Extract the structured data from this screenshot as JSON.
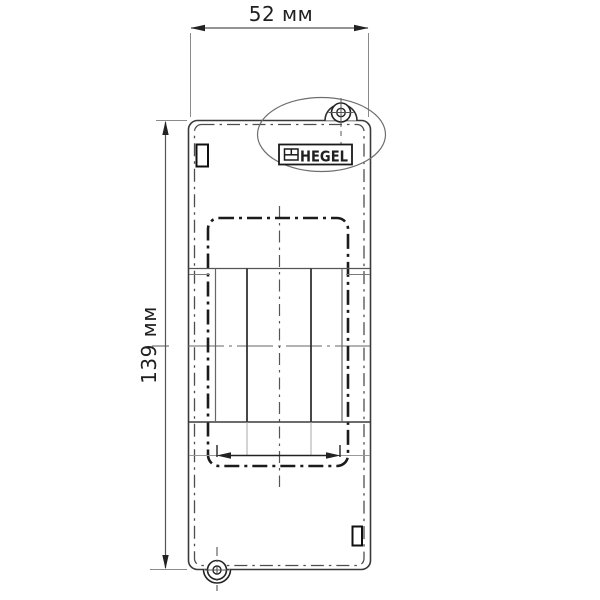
{
  "drawing": {
    "type": "technical-drawing-front-view",
    "brand_label": "HEGEL",
    "dimensions": {
      "width": "52 мм",
      "height": "139 мм"
    },
    "features": {
      "top_fastener": "screw-hole-boss-top",
      "bottom_fastener": "screw-hole-boss-bottom",
      "window_modules": 3,
      "highlight": "ellipse-around-brand-label"
    },
    "colors": {
      "background": "#ffffff",
      "line_dark": "#1b1b1b",
      "line_medium": "#4a4a4a",
      "line_light": "#8a8a8a",
      "text": "#1f1f1f"
    }
  }
}
